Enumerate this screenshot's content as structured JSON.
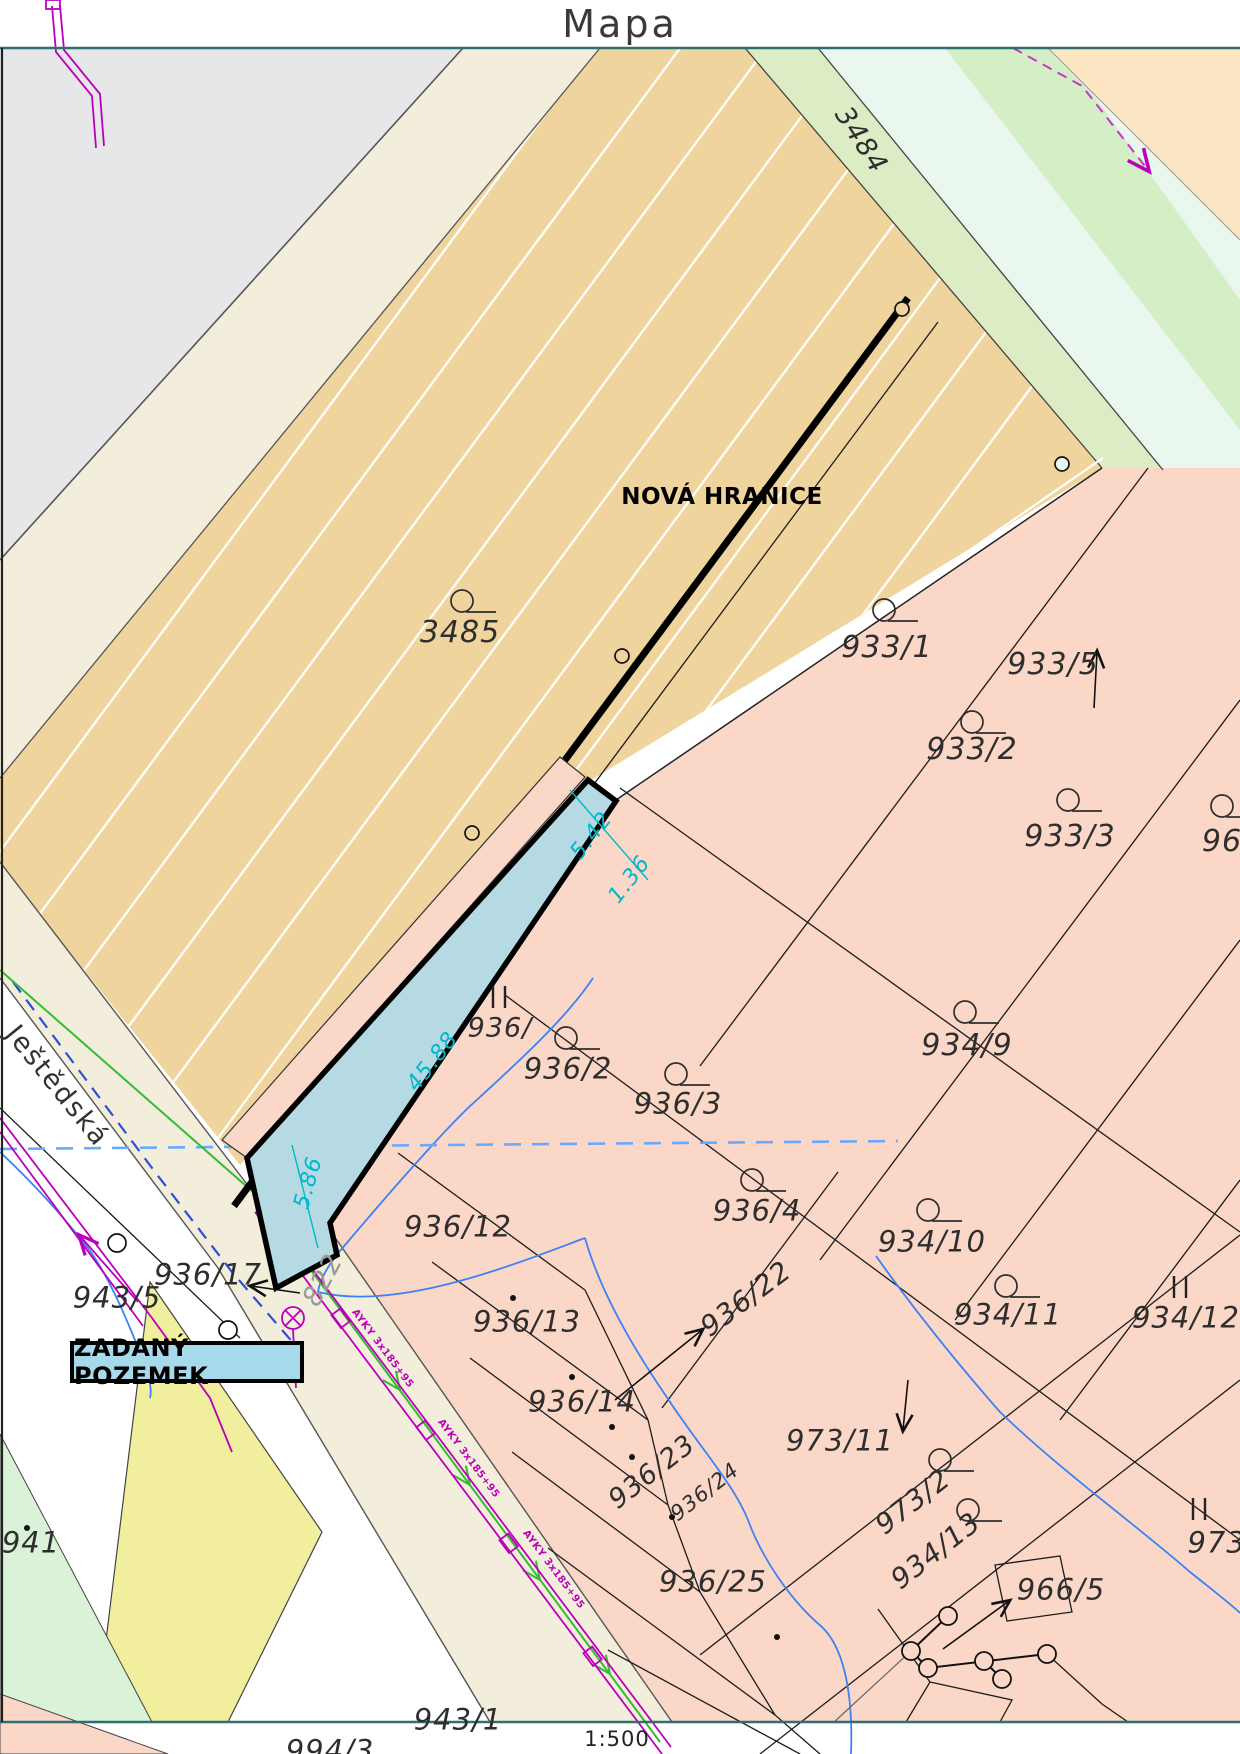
{
  "title": "Mapa",
  "scale": "1:500",
  "legend": {
    "new_boundary": "NOVÁ HRANICE",
    "target_parcel": "ZADANÝ POZEMEK"
  },
  "colors": {
    "tan_field": "#f0d49e",
    "pink_area": "#fbd7c8",
    "highlight_parcel": "#b5dae4",
    "road_cream": "#f3eedb",
    "gray_area": "#e7e6e9",
    "green_strip": "#dcedc6",
    "mint_area": "#e9f7ee",
    "peach_corner": "#fde6c4",
    "yellow_area": "#f1ee9e",
    "cyan_dim": "#00b8c8",
    "magenta_utility": "#bb00bb",
    "green_line": "#33bb33",
    "blue_stream": "#3b82f6",
    "frame_teal": "#2f6f6f"
  },
  "labels": [
    {
      "t": "3484",
      "x": 861,
      "y": 140,
      "r": 57,
      "c": "p",
      "s": 27
    },
    {
      "t": "3485",
      "x": 460,
      "y": 633,
      "r": 0,
      "c": "p",
      "s": 30
    },
    {
      "t": "933/1",
      "x": 887,
      "y": 648,
      "r": 0,
      "c": "p",
      "s": 30
    },
    {
      "t": "933/5",
      "x": 1053,
      "y": 665,
      "r": 0,
      "c": "p",
      "s": 30
    },
    {
      "t": "933/2",
      "x": 972,
      "y": 750,
      "r": 0,
      "c": "p",
      "s": 30
    },
    {
      "t": "933/3",
      "x": 1070,
      "y": 837,
      "r": 0,
      "c": "p",
      "s": 30
    },
    {
      "t": "968",
      "x": 1232,
      "y": 842,
      "r": 0,
      "c": "p",
      "s": 30
    },
    {
      "t": "934/9",
      "x": 967,
      "y": 1046,
      "r": 0,
      "c": "p",
      "s": 30
    },
    {
      "t": "936/2",
      "x": 568,
      "y": 1069,
      "r": 0,
      "c": "p",
      "s": 29
    },
    {
      "t": "936/3",
      "x": 678,
      "y": 1104,
      "r": 0,
      "c": "p",
      "s": 29
    },
    {
      "t": "936/4",
      "x": 757,
      "y": 1211,
      "r": 0,
      "c": "p",
      "s": 29
    },
    {
      "t": "934/10",
      "x": 932,
      "y": 1242,
      "r": 0,
      "c": "p",
      "s": 29
    },
    {
      "t": "936/22",
      "x": 746,
      "y": 1299,
      "r": -37,
      "c": "p",
      "s": 28
    },
    {
      "t": "934/11",
      "x": 1008,
      "y": 1315,
      "r": 0,
      "c": "p",
      "s": 29
    },
    {
      "t": "934/12",
      "x": 1186,
      "y": 1318,
      "r": 0,
      "c": "p",
      "s": 29
    },
    {
      "t": "936/12",
      "x": 458,
      "y": 1227,
      "r": 0,
      "c": "p",
      "s": 29
    },
    {
      "t": "936/",
      "x": 500,
      "y": 1028,
      "r": 0,
      "c": "p",
      "s": 27
    },
    {
      "t": "936/17",
      "x": 208,
      "y": 1275,
      "r": 0,
      "c": "p",
      "s": 29
    },
    {
      "t": "943/5",
      "x": 117,
      "y": 1298,
      "r": 0,
      "c": "p",
      "s": 29
    },
    {
      "t": "936/13",
      "x": 527,
      "y": 1322,
      "r": 0,
      "c": "p",
      "s": 29
    },
    {
      "t": "936/14",
      "x": 582,
      "y": 1402,
      "r": 0,
      "c": "p",
      "s": 29
    },
    {
      "t": "936/23",
      "x": 652,
      "y": 1472,
      "r": -38,
      "c": "p",
      "s": 27
    },
    {
      "t": "936/24",
      "x": 705,
      "y": 1492,
      "r": -38,
      "c": "p",
      "s": 21
    },
    {
      "t": "936/25",
      "x": 713,
      "y": 1582,
      "r": 0,
      "c": "p",
      "s": 29
    },
    {
      "t": "973/11",
      "x": 840,
      "y": 1441,
      "r": 0,
      "c": "p",
      "s": 29
    },
    {
      "t": "973/2",
      "x": 913,
      "y": 1502,
      "r": -38,
      "c": "p",
      "s": 28
    },
    {
      "t": "934/13",
      "x": 936,
      "y": 1551,
      "r": -38,
      "c": "p",
      "s": 28
    },
    {
      "t": "966/5",
      "x": 1061,
      "y": 1590,
      "r": 0,
      "c": "p",
      "s": 29
    },
    {
      "t": "973/",
      "x": 1222,
      "y": 1543,
      "r": 0,
      "c": "p",
      "s": 29
    },
    {
      "t": "941",
      "x": 31,
      "y": 1543,
      "r": 0,
      "c": "p",
      "s": 29
    },
    {
      "t": "943/1",
      "x": 458,
      "y": 1720,
      "r": 0,
      "c": "p",
      "s": 29
    },
    {
      "t": "994/3",
      "x": 330,
      "y": 1751,
      "r": 0,
      "c": "p",
      "s": 29
    },
    {
      "t": "822",
      "x": 323,
      "y": 1280,
      "r": -62,
      "c": "gray",
      "s": 27
    },
    {
      "t": "Ještědská",
      "x": 57,
      "y": 1086,
      "r": 51,
      "c": "street",
      "s": 27
    },
    {
      "t": "5.42",
      "x": 592,
      "y": 836,
      "r": -52,
      "c": "dim",
      "s": 22
    },
    {
      "t": "1.36",
      "x": 630,
      "y": 880,
      "r": -52,
      "c": "dim",
      "s": 22
    },
    {
      "t": "45.88",
      "x": 433,
      "y": 1062,
      "r": -52,
      "c": "dim",
      "s": 22
    },
    {
      "t": "5.86",
      "x": 309,
      "y": 1183,
      "r": -74,
      "c": "dim",
      "s": 22
    },
    {
      "t": "AYKY 3x185+95",
      "x": 382,
      "y": 1349,
      "r": 53,
      "c": "util",
      "s": 10
    },
    {
      "t": "AYKY 3x185+95",
      "x": 468,
      "y": 1459,
      "r": 53,
      "c": "util",
      "s": 10
    },
    {
      "t": "AYKY 3x185+95",
      "x": 553,
      "y": 1570,
      "r": 53,
      "c": "util",
      "s": 10
    }
  ]
}
